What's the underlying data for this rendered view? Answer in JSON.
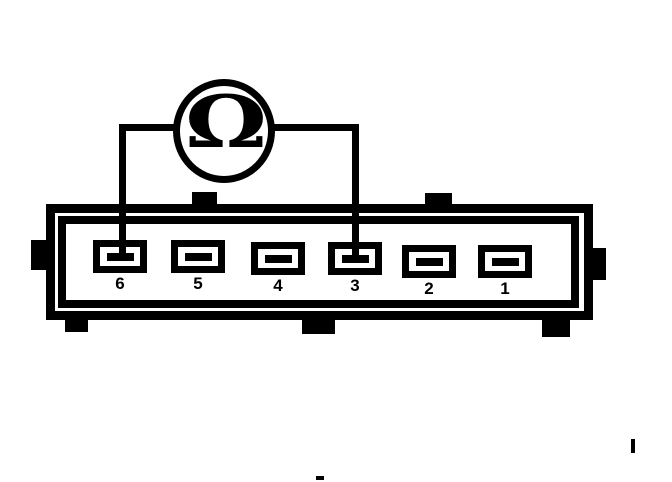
{
  "meter": {
    "symbol": "Ω",
    "name": "ohmmeter"
  },
  "connector": {
    "terminals": [
      {
        "label": "6"
      },
      {
        "label": "5"
      },
      {
        "label": "4"
      },
      {
        "label": "3"
      },
      {
        "label": "2"
      },
      {
        "label": "1"
      }
    ],
    "probe_connections": [
      "6",
      "3"
    ]
  },
  "colors": {
    "ink": "#000000",
    "background": "#ffffff"
  }
}
